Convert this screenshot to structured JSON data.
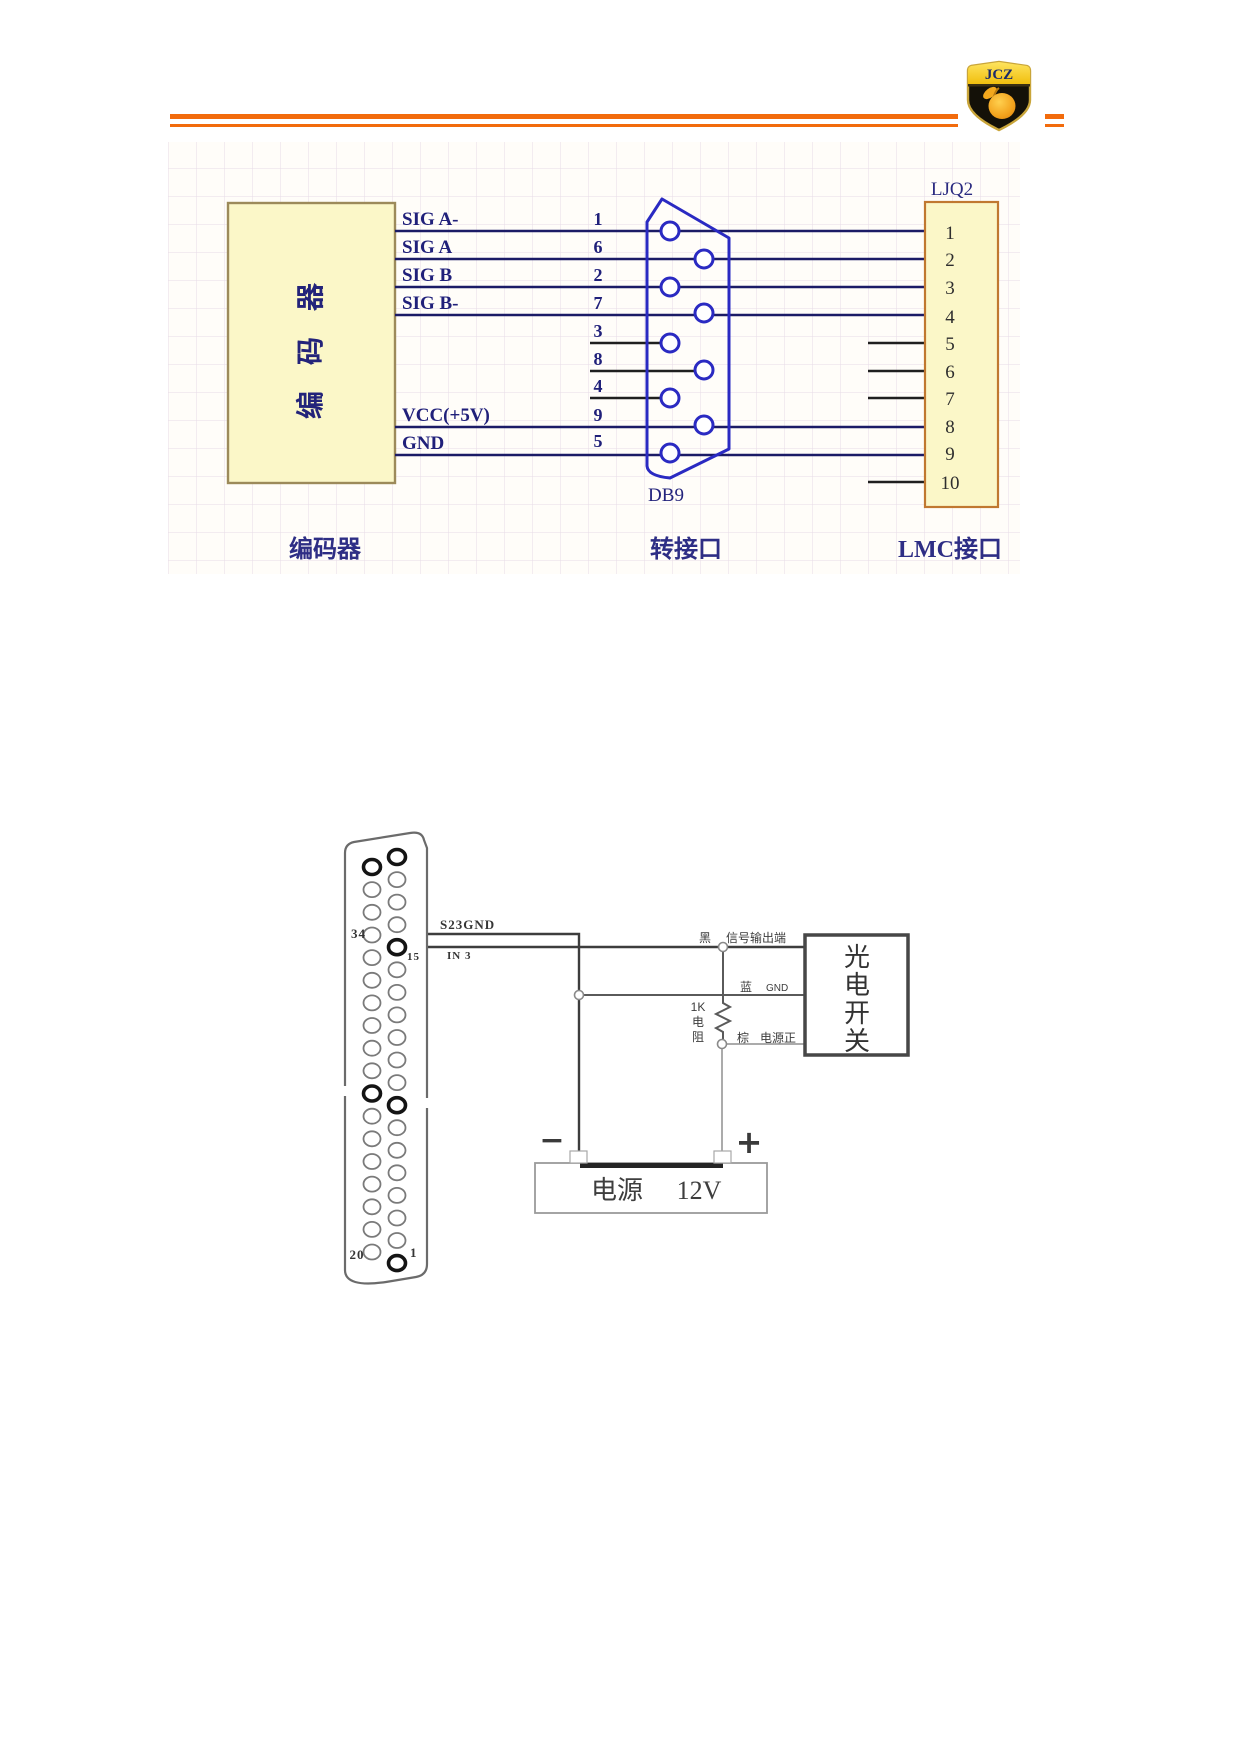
{
  "header": {
    "logo_text": "JCZ"
  },
  "diagram1": {
    "encoder_box_label": "编码器",
    "signal_names": [
      "SIG A-",
      "SIG A",
      "SIG B",
      "SIG B-",
      "VCC(+5V)",
      "GND"
    ],
    "db9_pins": [
      "1",
      "6",
      "2",
      "7",
      "3",
      "8",
      "4",
      "9",
      "5"
    ],
    "lmc_pins": [
      "1",
      "2",
      "3",
      "4",
      "5",
      "6",
      "7",
      "8",
      "9",
      "10"
    ],
    "connector_name": "LJQ2",
    "db9_label": "DB9",
    "captions": {
      "left": "编码器",
      "middle": "转接口",
      "right": "LMC接口"
    }
  },
  "diagram2": {
    "pins": {
      "p34": "34",
      "p15": "15",
      "p20": "20",
      "p1": "1"
    },
    "wires": {
      "s23gnd": "S23GND",
      "in3": "IN 3"
    },
    "sensor": {
      "chars": [
        "光",
        "电",
        "开",
        "关"
      ],
      "black": "黑",
      "black_desc": "信号输出端",
      "blue": "蓝",
      "blue_desc": "GND",
      "brown": "棕",
      "brown_desc": "电源正"
    },
    "resistor": {
      "l1": "1K",
      "l2": "电",
      "l3": "阻"
    },
    "psu": {
      "name": "电源",
      "voltage": "12V",
      "minus": "−",
      "plus": "+"
    }
  }
}
